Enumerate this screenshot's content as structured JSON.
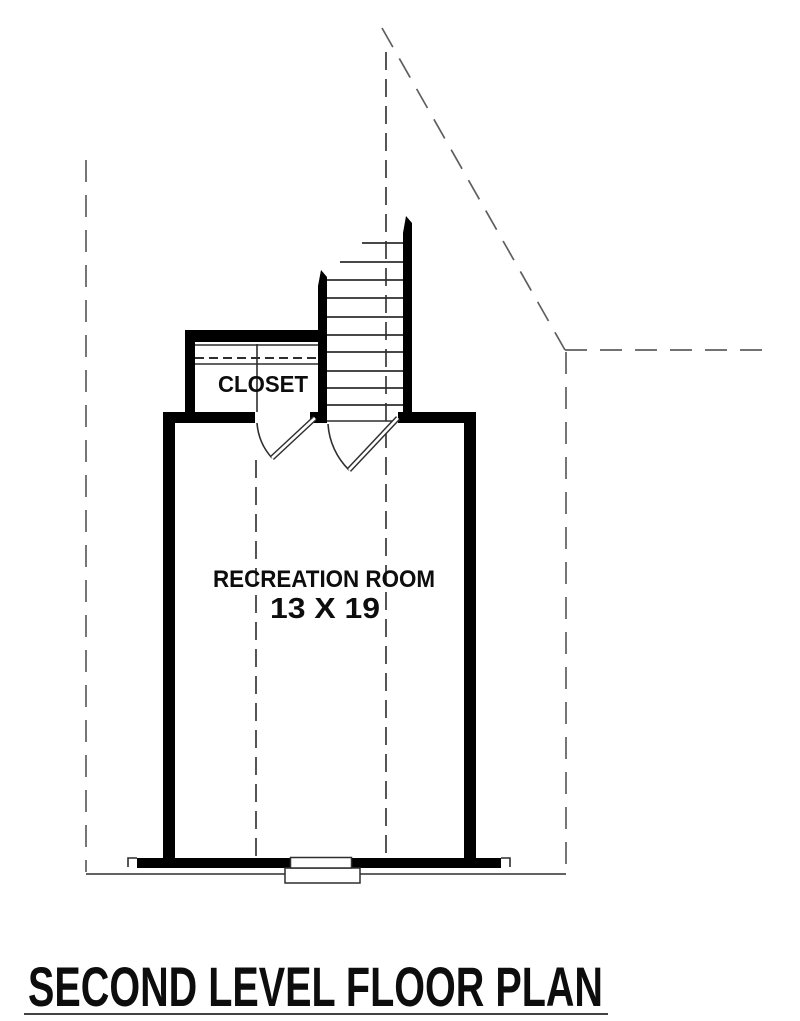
{
  "title": {
    "text": "SECOND LEVEL FLOOR PLAN"
  },
  "labels": {
    "closet": "CLOSET",
    "recreation_room": "RECREATION ROOM",
    "recreation_room_size": "13 X 19"
  },
  "colors": {
    "background": "#ffffff",
    "wall": "#000000",
    "thin_line": "#2e2e2e",
    "break_line": "#383838",
    "roof_dash_line": "#5f5f5f",
    "text": "#0d0d0d",
    "title_underline": "#444444"
  }
}
